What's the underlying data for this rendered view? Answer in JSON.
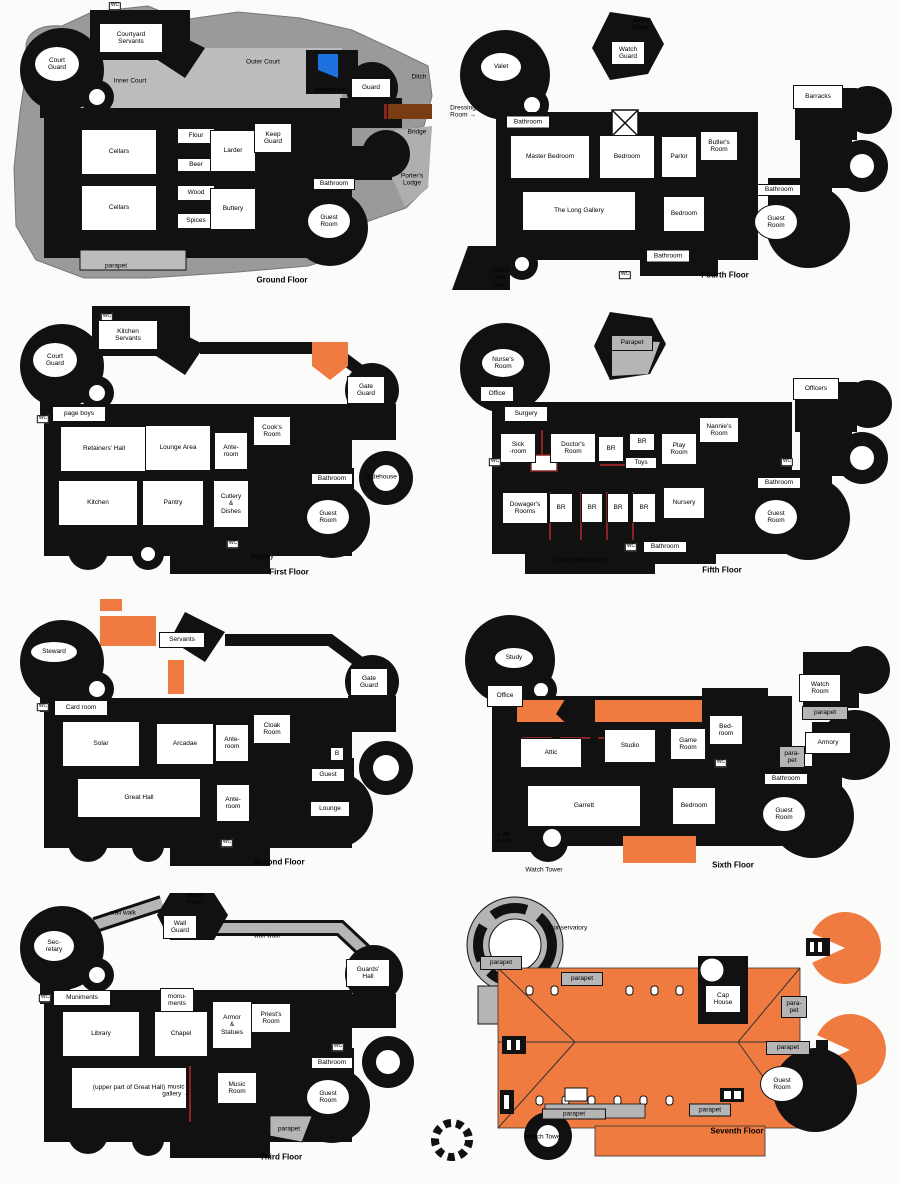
{
  "colors": {
    "black_walls": "#111111",
    "rock_gray": "#9A9A9A",
    "courtyard_gray": "#BCBCBC",
    "parapet_gray": "#B5B5B5",
    "roof_orange": "#EF7B40",
    "bridge_brown": "#7A3D12",
    "water_blue": "#1D72E0",
    "partition_red": "#8B2323"
  },
  "floors": [
    {
      "name": "Ground Floor",
      "rooms": [
        {
          "t": "WC",
          "k": "tiny",
          "x": 115,
          "y": 6
        },
        {
          "t": "Courtyard\nServants",
          "x": 131,
          "y": 38,
          "w": 64,
          "h": 30
        },
        {
          "t": "Court\nGuard",
          "x": 57,
          "y": 64,
          "w": 46,
          "h": 36,
          "round": true
        },
        {
          "t": "Inner Court",
          "k": "bare",
          "x": 130,
          "y": 81
        },
        {
          "t": "Outer Court",
          "k": "bare",
          "x": 263,
          "y": 62
        },
        {
          "t": "Bathhouse",
          "k": "bare",
          "x": 330,
          "y": 90
        },
        {
          "t": "Guard",
          "x": 371,
          "y": 88,
          "w": 40,
          "h": 20
        },
        {
          "t": "Ditch",
          "k": "bare",
          "x": 419,
          "y": 77
        },
        {
          "t": "Bridge",
          "k": "bare",
          "x": 417,
          "y": 132
        },
        {
          "t": "Porter's\nLodge",
          "k": "bare",
          "x": 412,
          "y": 180
        },
        {
          "t": "Cellars",
          "x": 119,
          "y": 152,
          "w": 76,
          "h": 46
        },
        {
          "t": "Cellars",
          "x": 119,
          "y": 208,
          "w": 76,
          "h": 46
        },
        {
          "t": "Flour",
          "x": 196,
          "y": 136,
          "w": 38,
          "h": 16
        },
        {
          "t": "Beer",
          "x": 196,
          "y": 165,
          "w": 38,
          "h": 14
        },
        {
          "t": "Wood",
          "x": 196,
          "y": 193,
          "w": 38,
          "h": 16
        },
        {
          "t": "Spices",
          "x": 196,
          "y": 221,
          "w": 38,
          "h": 16
        },
        {
          "t": "Larder",
          "x": 233,
          "y": 151,
          "w": 46,
          "h": 42
        },
        {
          "t": "Buttery",
          "x": 233,
          "y": 209,
          "w": 46,
          "h": 42
        },
        {
          "t": "Keep\nGuard",
          "x": 273,
          "y": 138,
          "w": 38,
          "h": 30
        },
        {
          "t": "Bathroom",
          "x": 334,
          "y": 184,
          "w": 42,
          "h": 12
        },
        {
          "t": "Guest\nRoom",
          "x": 329,
          "y": 221,
          "w": 44,
          "h": 36,
          "round": true
        },
        {
          "t": "parapet",
          "k": "bare",
          "x": 116,
          "y": 266
        },
        {
          "t": "Ground Floor",
          "k": "title",
          "x": 282,
          "y": 281
        }
      ]
    },
    {
      "name": "First Floor",
      "rooms": [
        {
          "t": "WC",
          "k": "tiny",
          "x": 107,
          "y": 317
        },
        {
          "t": "Kitchen\nServants",
          "x": 128,
          "y": 335,
          "w": 60,
          "h": 30
        },
        {
          "t": "Court\nGuard",
          "x": 55,
          "y": 360,
          "w": 46,
          "h": 36,
          "round": true
        },
        {
          "t": "WC",
          "k": "tiny",
          "x": 43,
          "y": 419
        },
        {
          "t": "page boys",
          "x": 79,
          "y": 414,
          "w": 54,
          "h": 16
        },
        {
          "t": "Retainers' Hall",
          "x": 104,
          "y": 449,
          "w": 88,
          "h": 46
        },
        {
          "t": "Lounge Area",
          "x": 178,
          "y": 448,
          "w": 66,
          "h": 46
        },
        {
          "t": "Ante-\nroom",
          "x": 231,
          "y": 451,
          "w": 34,
          "h": 38
        },
        {
          "t": "Cook's\nRoom",
          "x": 272,
          "y": 431,
          "w": 38,
          "h": 30
        },
        {
          "t": "Kitchen",
          "x": 98,
          "y": 503,
          "w": 80,
          "h": 46
        },
        {
          "t": "Pantry",
          "x": 173,
          "y": 503,
          "w": 62,
          "h": 46
        },
        {
          "t": "Cutlery\n&\nDishes",
          "x": 231,
          "y": 504,
          "w": 36,
          "h": 48
        },
        {
          "t": "WC",
          "k": "tiny",
          "x": 233,
          "y": 544
        },
        {
          "t": "Scullery",
          "k": "bare",
          "x": 262,
          "y": 557
        },
        {
          "t": "Bathroom",
          "x": 332,
          "y": 479,
          "w": 42,
          "h": 12
        },
        {
          "t": "Guest\nRoom",
          "x": 328,
          "y": 517,
          "w": 44,
          "h": 36,
          "round": true
        },
        {
          "t": "Gate\nGuard",
          "x": 366,
          "y": 390,
          "w": 38,
          "h": 28
        },
        {
          "t": "Gatehouse",
          "k": "bare",
          "x": 381,
          "y": 477
        },
        {
          "t": "First Floor",
          "k": "title",
          "x": 289,
          "y": 573
        }
      ]
    },
    {
      "name": "Second Floor",
      "rooms": [
        {
          "t": "Steward",
          "x": 54,
          "y": 652,
          "w": 48,
          "h": 22,
          "round": true
        },
        {
          "t": "Servants",
          "x": 182,
          "y": 640,
          "w": 46,
          "h": 16
        },
        {
          "t": "Card room",
          "x": 81,
          "y": 708,
          "w": 54,
          "h": 16
        },
        {
          "t": "WC",
          "k": "tiny",
          "x": 43,
          "y": 707
        },
        {
          "t": "Solar",
          "x": 101,
          "y": 744,
          "w": 78,
          "h": 46
        },
        {
          "t": "Arcadae",
          "x": 185,
          "y": 744,
          "w": 58,
          "h": 42
        },
        {
          "t": "Ante-\nroom",
          "x": 232,
          "y": 743,
          "w": 34,
          "h": 38
        },
        {
          "t": "Cloak\nRoom",
          "x": 272,
          "y": 729,
          "w": 38,
          "h": 30
        },
        {
          "t": "Gate\nGuard",
          "x": 369,
          "y": 682,
          "w": 38,
          "h": 28
        },
        {
          "t": "Great Hall",
          "x": 139,
          "y": 798,
          "w": 124,
          "h": 40
        },
        {
          "t": "Ante-\nroom",
          "x": 233,
          "y": 803,
          "w": 34,
          "h": 38
        },
        {
          "t": "B",
          "x": 337,
          "y": 754,
          "w": 14,
          "h": 14
        },
        {
          "t": "Guest",
          "x": 328,
          "y": 775,
          "w": 34,
          "h": 14
        },
        {
          "t": "Lounge",
          "x": 330,
          "y": 809,
          "w": 40,
          "h": 16
        },
        {
          "t": "WC",
          "k": "tiny",
          "x": 227,
          "y": 843
        },
        {
          "t": "Second Floor",
          "k": "title",
          "x": 279,
          "y": 863
        }
      ]
    },
    {
      "name": "Third Floor",
      "rooms": [
        {
          "t": "Watch\nTower",
          "k": "bare",
          "x": 195,
          "y": 900
        },
        {
          "t": "wall walk",
          "k": "bare",
          "x": 123,
          "y": 913
        },
        {
          "t": "Wall\nGuard",
          "x": 180,
          "y": 927,
          "w": 34,
          "h": 24
        },
        {
          "t": "wall walk",
          "k": "bare",
          "x": 267,
          "y": 936
        },
        {
          "t": "Sec-\nretary",
          "x": 54,
          "y": 946,
          "w": 42,
          "h": 32,
          "round": true
        },
        {
          "t": "WC",
          "k": "tiny",
          "x": 45,
          "y": 998
        },
        {
          "t": "Muniments",
          "x": 82,
          "y": 998,
          "w": 58,
          "h": 16
        },
        {
          "t": "monu-\nments",
          "x": 177,
          "y": 1000,
          "w": 34,
          "h": 24
        },
        {
          "t": "Library",
          "x": 101,
          "y": 1034,
          "w": 78,
          "h": 46
        },
        {
          "t": "Chapel",
          "x": 181,
          "y": 1034,
          "w": 54,
          "h": 46
        },
        {
          "t": "Armor\n&\nStatues",
          "x": 232,
          "y": 1025,
          "w": 40,
          "h": 48
        },
        {
          "t": "Priest's\nRoom",
          "x": 271,
          "y": 1018,
          "w": 40,
          "h": 30
        },
        {
          "t": "Guards'\nHall",
          "x": 368,
          "y": 973,
          "w": 44,
          "h": 28
        },
        {
          "t": "WC",
          "k": "tiny",
          "x": 338,
          "y": 1047
        },
        {
          "t": "(upper part of Great Hall)",
          "x": 129,
          "y": 1088,
          "w": 116,
          "h": 42
        },
        {
          "t": "music\ngallery →",
          "k": "bare",
          "x": 176,
          "y": 1091
        },
        {
          "t": "Music\nRoom",
          "x": 237,
          "y": 1088,
          "w": 40,
          "h": 32
        },
        {
          "t": "Bathroom",
          "x": 332,
          "y": 1063,
          "w": 42,
          "h": 12
        },
        {
          "t": "Guest\nRoom",
          "x": 328,
          "y": 1097,
          "w": 44,
          "h": 36,
          "round": true
        },
        {
          "t": "parapet",
          "k": "bare",
          "x": 289,
          "y": 1129
        },
        {
          "t": "Third Floor",
          "k": "title",
          "x": 281,
          "y": 1158
        }
      ]
    },
    {
      "name": "Fourth Floor",
      "rooms": [
        {
          "t": "Watch\nTower",
          "k": "bare",
          "x": 640,
          "y": 25
        },
        {
          "t": "Watch\nGuard",
          "x": 628,
          "y": 53,
          "w": 34,
          "h": 24
        },
        {
          "t": "Valet",
          "x": 501,
          "y": 67,
          "w": 42,
          "h": 30,
          "round": true
        },
        {
          "t": "Dressing\nRoom →",
          "k": "bare",
          "x": 463,
          "y": 112
        },
        {
          "t": "Bathroom",
          "x": 528,
          "y": 122,
          "w": 44,
          "h": 13
        },
        {
          "t": "Master Bedroom",
          "x": 550,
          "y": 157,
          "w": 80,
          "h": 44
        },
        {
          "t": "Bedroom",
          "x": 627,
          "y": 157,
          "w": 56,
          "h": 44
        },
        {
          "t": "Parlor",
          "x": 679,
          "y": 157,
          "w": 36,
          "h": 42
        },
        {
          "t": "Butler's\nRoom",
          "x": 719,
          "y": 146,
          "w": 38,
          "h": 30
        },
        {
          "t": "Barracks",
          "x": 818,
          "y": 97,
          "w": 50,
          "h": 24
        },
        {
          "t": "The Long Gallery",
          "x": 579,
          "y": 211,
          "w": 114,
          "h": 40
        },
        {
          "t": "Bedroom",
          "x": 684,
          "y": 214,
          "w": 42,
          "h": 36
        },
        {
          "t": "Bathroom",
          "x": 668,
          "y": 256,
          "w": 44,
          "h": 13
        },
        {
          "t": "WC",
          "k": "tiny",
          "x": 625,
          "y": 275
        },
        {
          "t": "(secret\nexit\nstair)",
          "k": "bare",
          "x": 500,
          "y": 278
        },
        {
          "t": "Bathroom",
          "x": 779,
          "y": 190,
          "w": 44,
          "h": 12
        },
        {
          "t": "Guest\nRoom",
          "x": 776,
          "y": 222,
          "w": 44,
          "h": 36,
          "round": true
        },
        {
          "t": "Fourth Floor",
          "k": "title",
          "x": 725,
          "y": 276
        }
      ]
    },
    {
      "name": "Fifth Floor",
      "rooms": [
        {
          "t": "Parapet",
          "k": "zone",
          "x": 632,
          "y": 343,
          "w": 42,
          "h": 16
        },
        {
          "t": "Nurse's\nRoom",
          "x": 503,
          "y": 363,
          "w": 44,
          "h": 30,
          "round": true
        },
        {
          "t": "Office",
          "x": 497,
          "y": 394,
          "w": 34,
          "h": 16
        },
        {
          "t": "Surgery",
          "x": 526,
          "y": 414,
          "w": 44,
          "h": 16
        },
        {
          "t": "Sick\n-room",
          "x": 518,
          "y": 448,
          "w": 36,
          "h": 30
        },
        {
          "t": "Doctor's\nRoom",
          "x": 573,
          "y": 448,
          "w": 46,
          "h": 30
        },
        {
          "t": "BR",
          "x": 611,
          "y": 449,
          "w": 26,
          "h": 26
        },
        {
          "t": "BR",
          "x": 642,
          "y": 442,
          "w": 26,
          "h": 18
        },
        {
          "t": "Toys",
          "x": 641,
          "y": 463,
          "w": 32,
          "h": 12
        },
        {
          "t": "Play\nRoom",
          "x": 679,
          "y": 449,
          "w": 36,
          "h": 32
        },
        {
          "t": "Nannie's\nRoom",
          "x": 719,
          "y": 430,
          "w": 40,
          "h": 26
        },
        {
          "t": "Officers",
          "x": 816,
          "y": 389,
          "w": 46,
          "h": 22
        },
        {
          "t": "WC",
          "k": "tiny",
          "x": 495,
          "y": 462
        },
        {
          "t": "Dowager's\nRooms",
          "x": 525,
          "y": 508,
          "w": 46,
          "h": 32
        },
        {
          "t": "BR",
          "x": 561,
          "y": 508,
          "w": 24,
          "h": 30
        },
        {
          "t": "BR",
          "x": 592,
          "y": 508,
          "w": 22,
          "h": 30
        },
        {
          "t": "BR",
          "x": 618,
          "y": 508,
          "w": 22,
          "h": 30
        },
        {
          "t": "BR",
          "x": 644,
          "y": 508,
          "w": 24,
          "h": 30
        },
        {
          "t": "Nursery",
          "x": 684,
          "y": 503,
          "w": 42,
          "h": 32
        },
        {
          "t": "WC",
          "k": "tiny",
          "x": 631,
          "y": 547
        },
        {
          "t": "Bathroom",
          "x": 665,
          "y": 547,
          "w": 44,
          "h": 12
        },
        {
          "t": "Garrett Bedrooms",
          "k": "bare",
          "x": 580,
          "y": 560
        },
        {
          "t": "WC",
          "k": "tiny",
          "x": 787,
          "y": 462
        },
        {
          "t": "Bathroom",
          "x": 779,
          "y": 483,
          "w": 44,
          "h": 12
        },
        {
          "t": "Guest\nRoom",
          "x": 776,
          "y": 517,
          "w": 44,
          "h": 36,
          "round": true
        },
        {
          "t": "Fifth Floor",
          "k": "title",
          "x": 722,
          "y": 571
        }
      ]
    },
    {
      "name": "Sixth Floor",
      "rooms": [
        {
          "t": "Study",
          "x": 514,
          "y": 658,
          "w": 40,
          "h": 22,
          "round": true
        },
        {
          "t": "Office",
          "x": 505,
          "y": 696,
          "w": 36,
          "h": 22
        },
        {
          "t": "Attic",
          "x": 551,
          "y": 753,
          "w": 62,
          "h": 30
        },
        {
          "t": "Studio",
          "x": 630,
          "y": 746,
          "w": 52,
          "h": 34
        },
        {
          "t": "Game\nRoom",
          "x": 688,
          "y": 744,
          "w": 36,
          "h": 32
        },
        {
          "t": "Bed-\nroom",
          "x": 726,
          "y": 730,
          "w": 34,
          "h": 30
        },
        {
          "t": "WC",
          "k": "tiny",
          "x": 721,
          "y": 763
        },
        {
          "t": "Watch\nRoom",
          "x": 820,
          "y": 688,
          "w": 42,
          "h": 28
        },
        {
          "t": "parapet",
          "k": "zone",
          "x": 825,
          "y": 713,
          "w": 46,
          "h": 14
        },
        {
          "t": "Armory",
          "x": 828,
          "y": 743,
          "w": 46,
          "h": 22
        },
        {
          "t": "para-\npet",
          "k": "zone",
          "x": 792,
          "y": 757,
          "w": 26,
          "h": 22
        },
        {
          "t": "Bathroom",
          "x": 786,
          "y": 779,
          "w": 44,
          "h": 12
        },
        {
          "t": "Guest\nRoom",
          "x": 784,
          "y": 814,
          "w": 44,
          "h": 36,
          "round": true
        },
        {
          "t": "Garrett",
          "x": 584,
          "y": 806,
          "w": 114,
          "h": 42
        },
        {
          "t": "Bedroom",
          "x": 694,
          "y": 806,
          "w": 44,
          "h": 38
        },
        {
          "t": "Cap\nHouse",
          "k": "bare",
          "x": 504,
          "y": 838
        },
        {
          "t": "Watch Tower",
          "k": "bare",
          "x": 544,
          "y": 870
        },
        {
          "t": "Sixth Floor",
          "k": "title",
          "x": 733,
          "y": 866
        }
      ]
    },
    {
      "name": "Seventh Floor",
      "rooms": [
        {
          "t": "Conservatory",
          "k": "bare",
          "x": 568,
          "y": 928
        },
        {
          "t": "parapet",
          "k": "zone",
          "x": 501,
          "y": 963,
          "w": 42,
          "h": 14
        },
        {
          "t": "parapet",
          "k": "zone",
          "x": 582,
          "y": 979,
          "w": 42,
          "h": 14
        },
        {
          "t": "Cap\nHouse",
          "x": 723,
          "y": 999,
          "w": 36,
          "h": 28
        },
        {
          "t": "para-\npet",
          "k": "zone",
          "x": 794,
          "y": 1007,
          "w": 26,
          "h": 22
        },
        {
          "t": "parapet",
          "k": "zone",
          "x": 788,
          "y": 1048,
          "w": 44,
          "h": 14
        },
        {
          "t": "Guest\nRoom",
          "x": 782,
          "y": 1084,
          "w": 44,
          "h": 36,
          "round": true
        },
        {
          "t": "parapet",
          "k": "zone",
          "x": 574,
          "y": 1114,
          "w": 64,
          "h": 11
        },
        {
          "t": "parapet",
          "k": "zone",
          "x": 710,
          "y": 1110,
          "w": 42,
          "h": 13
        },
        {
          "t": "Watch Tower",
          "k": "bare",
          "x": 544,
          "y": 1137
        },
        {
          "t": "Seventh Floor",
          "k": "title",
          "x": 737,
          "y": 1132
        }
      ]
    }
  ]
}
